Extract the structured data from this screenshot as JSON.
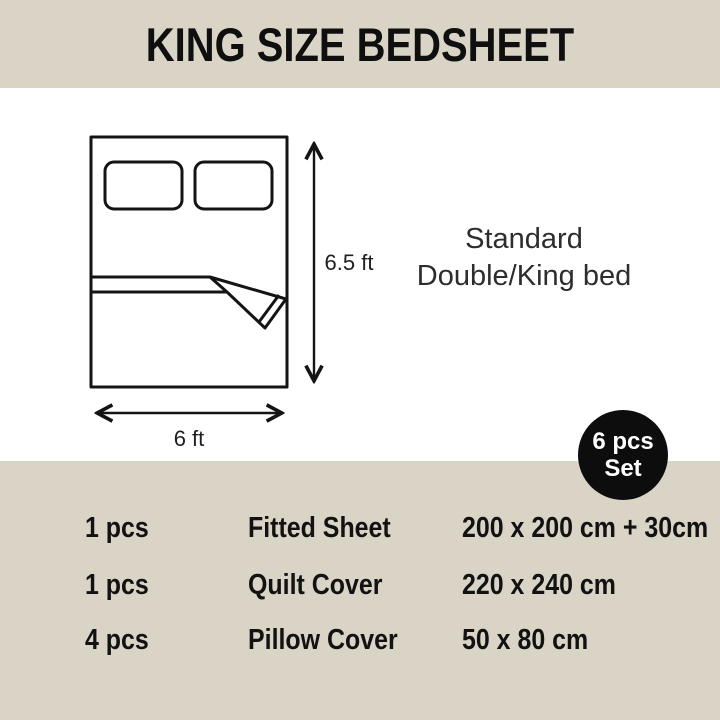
{
  "header": {
    "title": "KING SIZE BEDSHEET"
  },
  "diagram": {
    "height_label": "6.5 ft",
    "width_label": "6 ft",
    "caption_line1": "Standard",
    "caption_line2": "Double/King bed"
  },
  "badge": {
    "line1": "6 pcs",
    "line2": "Set"
  },
  "set_contents": {
    "rows": [
      {
        "qty": "1 pcs",
        "item": "Fitted Sheet",
        "size": "200 x 200 cm + 30cm"
      },
      {
        "qty": "1 pcs",
        "item": "Quilt Cover",
        "size": "220 x 240 cm"
      },
      {
        "qty": "4 pcs",
        "item": "Pillow Cover",
        "size": "50 x 80 cm"
      }
    ]
  },
  "colors": {
    "beige": "#dad4c7",
    "ink": "#141414",
    "caption": "#2d2d2d",
    "badge_bg": "#0d0d0d",
    "badge_text": "#ffffff",
    "white": "#ffffff"
  }
}
